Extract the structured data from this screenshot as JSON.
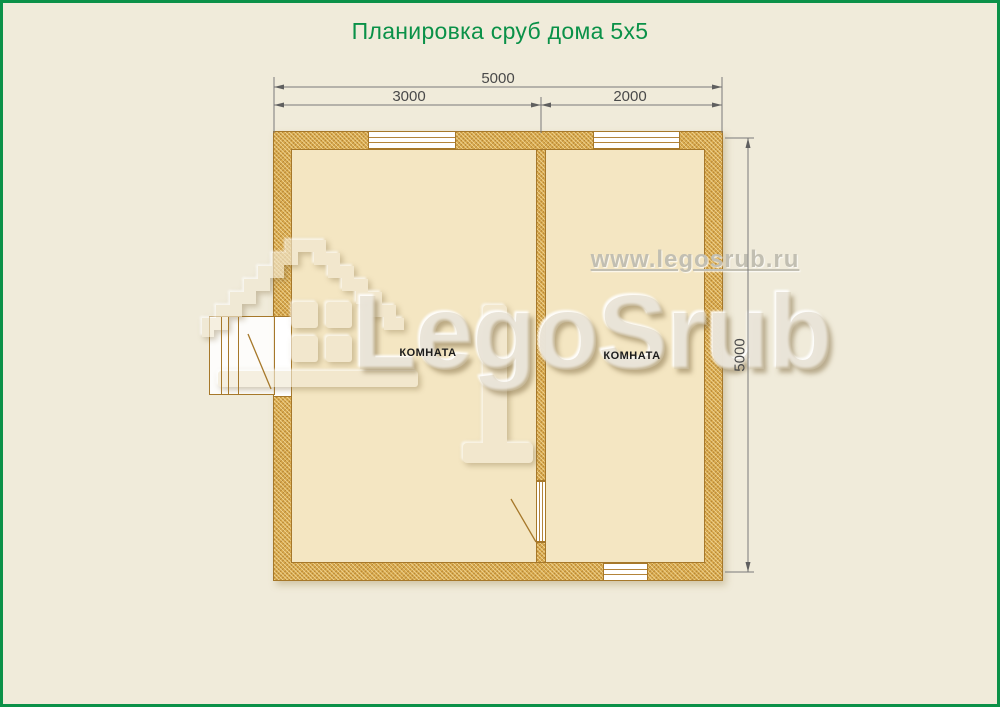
{
  "page": {
    "title": "Планировка сруб дома 5x5",
    "background_color": "#f0ebda",
    "border_color": "#0b9148",
    "title_color": "#0a9148"
  },
  "plan": {
    "room_labels": [
      "КОМНАТА",
      "КОМНАТА"
    ],
    "dimensions": {
      "width_total": "5000",
      "width_left": "3000",
      "width_right": "2000",
      "height_total": "5000"
    },
    "colors": {
      "wall_fill": "#d8a94d",
      "wall_border": "#a6782a",
      "room_fill": "#f4e6c2",
      "dimension_line": "#6b6b6b"
    }
  },
  "watermark": {
    "site_url": "www.legosrub.ru",
    "logo_text": "LegoSrub",
    "logo_icon": "pixel-house-icon"
  }
}
